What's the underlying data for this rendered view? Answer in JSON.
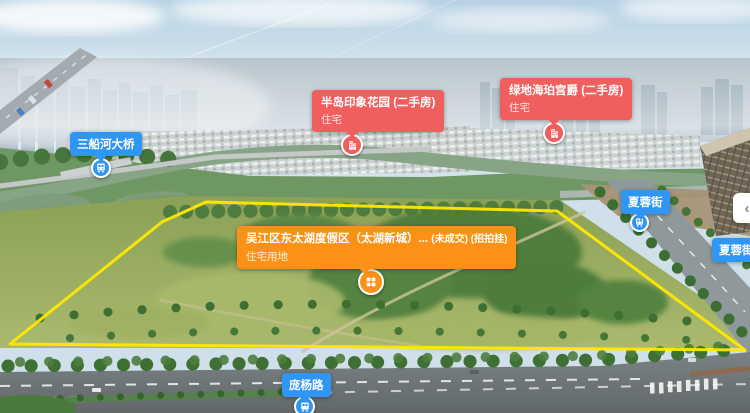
{
  "colors": {
    "resale_red": "#f15e5e",
    "transit_blue": "#3096f3",
    "parcel_orange": "#fb9217",
    "polygon_yellow": "#ffe800"
  },
  "parcel": {
    "title": "吴江区东太湖度假区（太湖新城）...",
    "status": "(未成交) (招拍挂)",
    "subtitle": "住宅用地",
    "marker_icon": "land-grid-icon"
  },
  "estates": [
    {
      "title": "半岛印象花园 (二手房)",
      "subtitle": "住宅",
      "marker_icon": "building-icon"
    },
    {
      "title": "绿地海珀宫爵 (二手房)",
      "subtitle": "住宅",
      "marker_icon": "building-icon"
    }
  ],
  "transit": [
    {
      "label": "三船河大桥",
      "marker_icon": "bus-icon"
    },
    {
      "label": "夏蓉街",
      "marker_icon": "bus-icon"
    },
    {
      "label": "夏蓉街庞",
      "marker_icon": "bus-icon"
    },
    {
      "label": "庞杨路",
      "marker_icon": "bus-icon"
    }
  ],
  "controls": {
    "collapse_chevron": "‹"
  }
}
